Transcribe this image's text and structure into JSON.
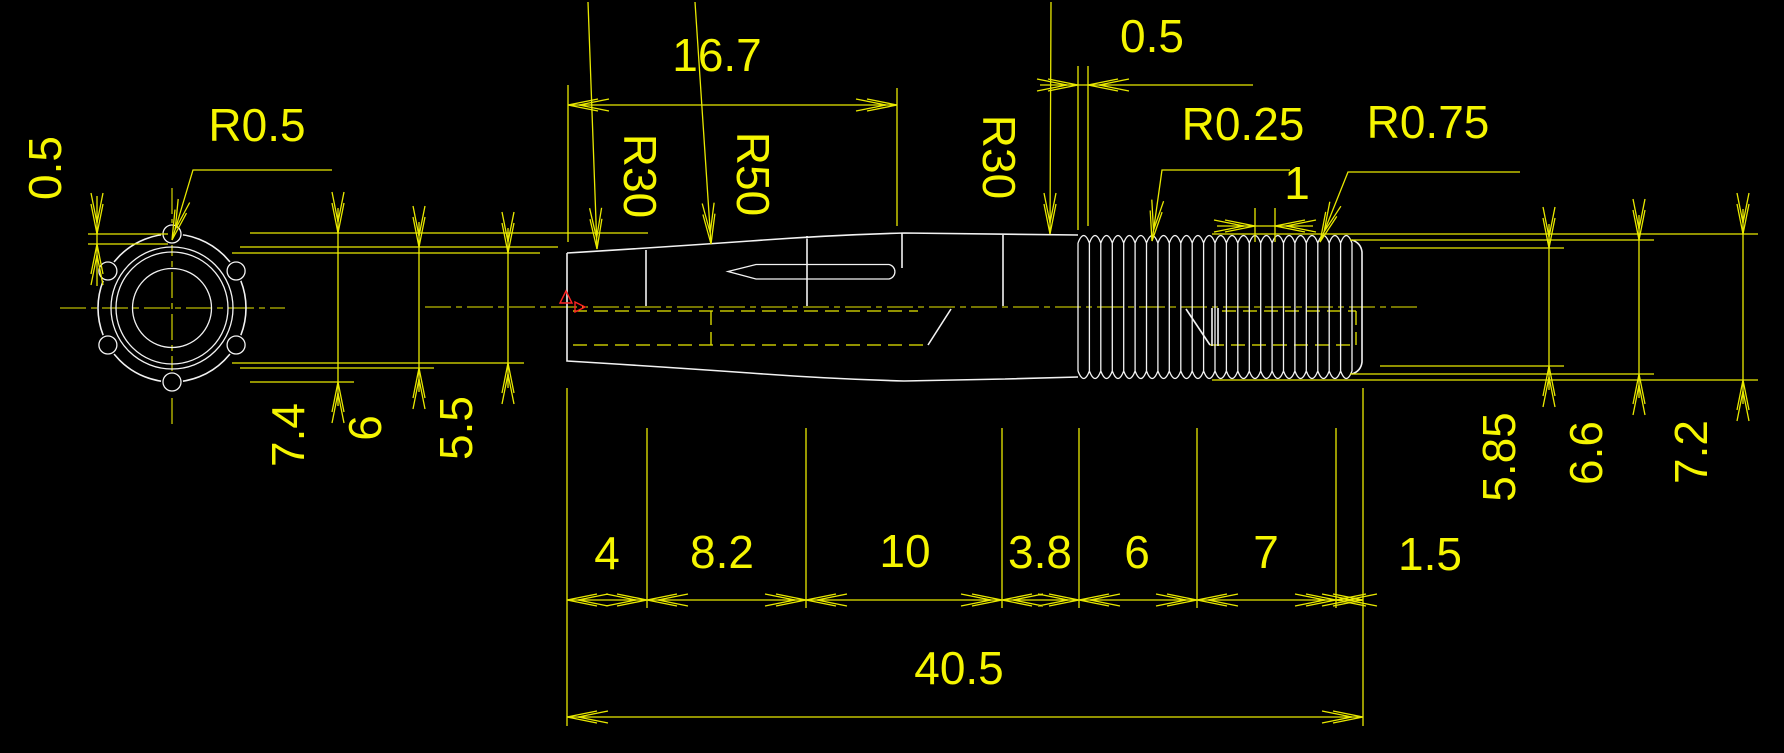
{
  "front_view": {
    "notch_radius": "R0.5",
    "notch_depth": "0.5"
  },
  "profile_annotations": {
    "tip_length": "16.7",
    "taper_r30_front": "R30",
    "taper_r50": "R50",
    "taper_r30_rear": "R30",
    "groove_width": "0.5",
    "knurl_radius_small": "R0.25",
    "knurl_radius_large": "R0.75",
    "knurl_pitch": "1"
  },
  "diameters_left": [
    "7.4",
    "6",
    "5.5"
  ],
  "diameters_right": [
    "5.85",
    "6.6",
    "7.2"
  ],
  "length_segments": [
    "4",
    "8.2",
    "10",
    "3.8",
    "6",
    "7",
    "1.5"
  ],
  "overall_length": "40.5",
  "colors": {
    "background": "#000000",
    "geometry": "#f2f2f2",
    "dimension": "#f0f000",
    "marker": "#ff2222"
  }
}
